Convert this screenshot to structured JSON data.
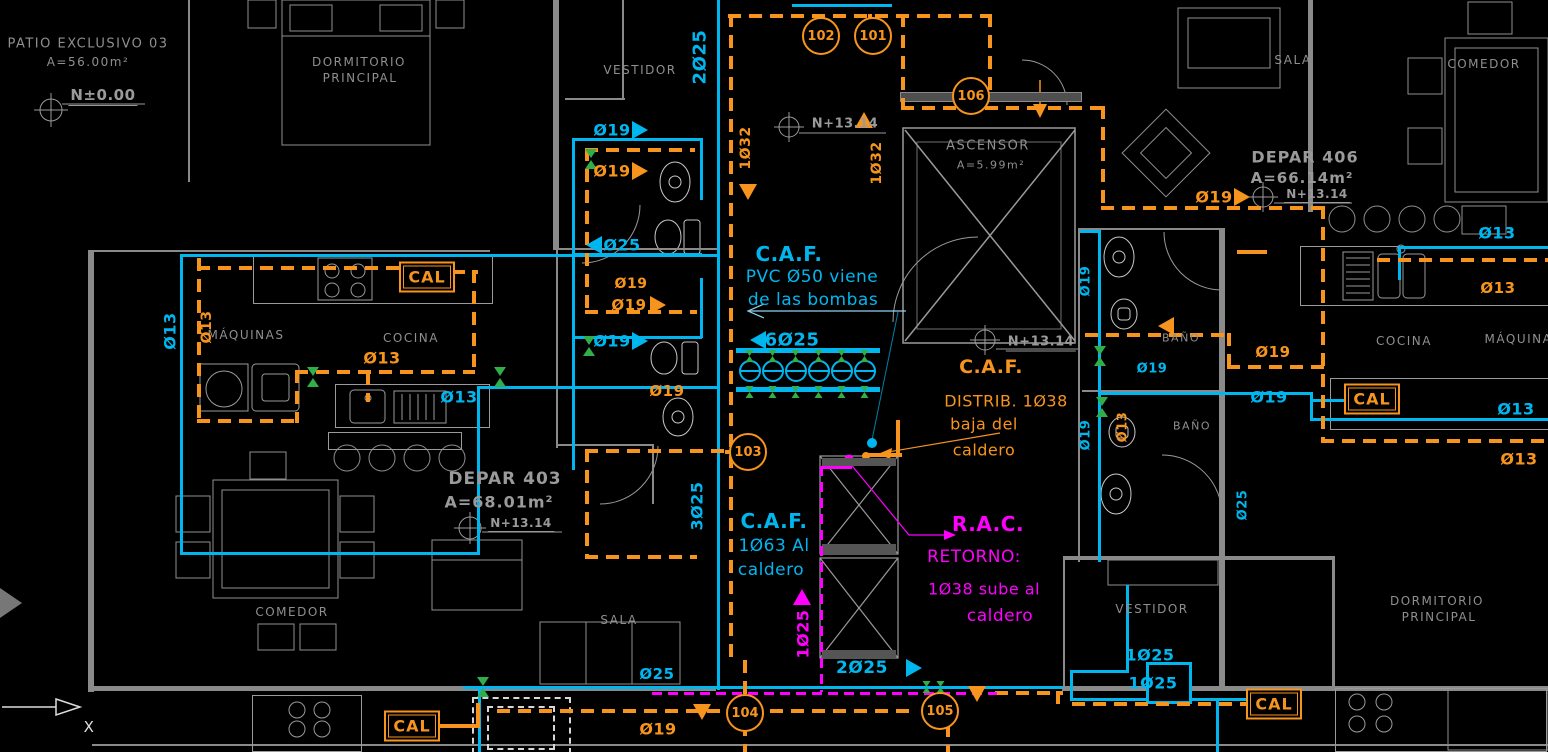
{
  "meta": {
    "background": "#000000",
    "colors": {
      "cold_water_cyan": "#00b6ef",
      "hot_water_orange": "#f7941d",
      "return_magenta": "#ff00ff",
      "valve_green": "#2fae49",
      "architecture_gray": "#8f8f8f"
    }
  },
  "rooms": [
    {
      "t": "PATIO EXCLUSIVO 03",
      "x": 88,
      "y": 44,
      "s": 13
    },
    {
      "t": "A=56.00m²",
      "x": 88,
      "y": 62,
      "s": 12
    },
    {
      "t": "DORMITORIO",
      "x": 359,
      "y": 62,
      "s": 12
    },
    {
      "t": "PRINCIPAL",
      "x": 360,
      "y": 78,
      "s": 12
    },
    {
      "t": "VESTIDOR",
      "x": 640,
      "y": 70,
      "s": 12
    },
    {
      "t": "ASCENSOR",
      "x": 988,
      "y": 146,
      "s": 13
    },
    {
      "t": "A=5.99m²",
      "x": 991,
      "y": 165,
      "s": 11
    },
    {
      "t": "SALA",
      "x": 1293,
      "y": 60,
      "s": 12
    },
    {
      "t": "COMEDOR",
      "x": 1484,
      "y": 64,
      "s": 12
    },
    {
      "t": "MÁQUINAS",
      "x": 246,
      "y": 335,
      "s": 12
    },
    {
      "t": "COCINA",
      "x": 411,
      "y": 338,
      "s": 12
    },
    {
      "t": "COMEDOR",
      "x": 292,
      "y": 612,
      "s": 12
    },
    {
      "t": "SALA",
      "x": 619,
      "y": 620,
      "s": 12
    },
    {
      "t": "BAÑO",
      "x": 1181,
      "y": 338,
      "s": 11
    },
    {
      "t": "BAÑO",
      "x": 1192,
      "y": 426,
      "s": 11
    },
    {
      "t": "COCINA",
      "x": 1404,
      "y": 341,
      "s": 12
    },
    {
      "t": "MÁQUINAS",
      "x": 1523,
      "y": 339,
      "s": 12
    },
    {
      "t": "VESTIDOR",
      "x": 1152,
      "y": 609,
      "s": 12
    },
    {
      "t": "DORMITORIO",
      "x": 1437,
      "y": 601,
      "s": 12
    },
    {
      "t": "PRINCIPAL",
      "x": 1439,
      "y": 617,
      "s": 12
    }
  ],
  "areas": [
    {
      "t": "DEPAR 403",
      "x": 505,
      "y": 479,
      "s": 17
    },
    {
      "t": "A=68.01m²",
      "x": 499,
      "y": 502,
      "s": 16
    },
    {
      "t": "DEPAR 406",
      "x": 1305,
      "y": 157,
      "s": 16
    },
    {
      "t": "A=66.14m²",
      "x": 1302,
      "y": 178,
      "s": 15
    }
  ],
  "levels": [
    {
      "t": "N±0.00",
      "x": 103,
      "y": 96,
      "s": 15
    },
    {
      "t": "N+13.14",
      "x": 845,
      "y": 125,
      "s": 13
    },
    {
      "t": "N+13.14",
      "x": 1041,
      "y": 343,
      "s": 13
    },
    {
      "t": "N+13.14",
      "x": 1317,
      "y": 195,
      "s": 12
    },
    {
      "t": "N+13.14",
      "x": 521,
      "y": 524,
      "s": 12
    }
  ],
  "pipe_labels": [
    {
      "t": "2Ø25",
      "x": 700,
      "y": 57,
      "c": "cy",
      "r": 1,
      "s": 18
    },
    {
      "t": "Ø19",
      "x": 612,
      "y": 130,
      "c": "cy",
      "s": 16
    },
    {
      "t": "Ø25",
      "x": 622,
      "y": 245,
      "c": "cy",
      "s": 16
    },
    {
      "t": "Ø19",
      "x": 612,
      "y": 341,
      "c": "cy",
      "s": 16
    },
    {
      "t": "Ø13",
      "x": 170,
      "y": 331,
      "c": "cy",
      "r": 1,
      "s": 16
    },
    {
      "t": "Ø13",
      "x": 459,
      "y": 397,
      "c": "cy",
      "s": 16
    },
    {
      "t": "6Ø25",
      "x": 792,
      "y": 340,
      "c": "cy",
      "s": 18
    },
    {
      "t": "3Ø25",
      "x": 697,
      "y": 506,
      "c": "cy",
      "r": 1,
      "s": 16
    },
    {
      "t": "Ø25",
      "x": 657,
      "y": 674,
      "c": "cy",
      "s": 15
    },
    {
      "t": "2Ø25",
      "x": 862,
      "y": 668,
      "c": "cy",
      "s": 17
    },
    {
      "t": "Ø13",
      "x": 1497,
      "y": 233,
      "c": "cy",
      "s": 16
    },
    {
      "t": "Ø13",
      "x": 1516,
      "y": 409,
      "c": "cy",
      "s": 16
    },
    {
      "t": "Ø19",
      "x": 1086,
      "y": 281,
      "c": "cy",
      "r": 1,
      "s": 13
    },
    {
      "t": "Ø19",
      "x": 1086,
      "y": 435,
      "c": "cy",
      "r": 1,
      "s": 13
    },
    {
      "t": "Ø19",
      "x": 1152,
      "y": 369,
      "c": "cy",
      "s": 13
    },
    {
      "t": "Ø19",
      "x": 1269,
      "y": 397,
      "c": "cy",
      "s": 16
    },
    {
      "t": "Ø25",
      "x": 1243,
      "y": 505,
      "c": "cy",
      "r": 1,
      "s": 13
    },
    {
      "t": "1Ø25",
      "x": 1150,
      "y": 655,
      "c": "cy",
      "s": 16
    },
    {
      "t": "1Ø25",
      "x": 1153,
      "y": 683,
      "c": "cy",
      "s": 16
    },
    {
      "t": "Ø19",
      "x": 612,
      "y": 171,
      "c": "or",
      "s": 16
    },
    {
      "t": "Ø19",
      "x": 631,
      "y": 284,
      "c": "or",
      "s": 14
    },
    {
      "t": "Ø19",
      "x": 629,
      "y": 305,
      "c": "or",
      "s": 15
    },
    {
      "t": "Ø19",
      "x": 667,
      "y": 391,
      "c": "or",
      "s": 15
    },
    {
      "t": "Ø13",
      "x": 207,
      "y": 327,
      "c": "or",
      "r": 1,
      "s": 14
    },
    {
      "t": "Ø13",
      "x": 382,
      "y": 358,
      "c": "or",
      "s": 16
    },
    {
      "t": "1Ø32",
      "x": 746,
      "y": 148,
      "c": "or",
      "r": 1,
      "s": 14
    },
    {
      "t": "1Ø32",
      "x": 877,
      "y": 163,
      "c": "or",
      "r": 1,
      "s": 14
    },
    {
      "t": "Ø19",
      "x": 1214,
      "y": 197,
      "c": "or",
      "s": 16
    },
    {
      "t": "Ø19",
      "x": 1273,
      "y": 352,
      "c": "or",
      "s": 15
    },
    {
      "t": "Ø13",
      "x": 1498,
      "y": 288,
      "c": "or",
      "s": 15
    },
    {
      "t": "Ø13",
      "x": 1519,
      "y": 459,
      "c": "or",
      "s": 16
    },
    {
      "t": "Ø13",
      "x": 1123,
      "y": 427,
      "c": "or",
      "r": 1,
      "s": 13
    },
    {
      "t": "Ø19",
      "x": 658,
      "y": 729,
      "c": "or",
      "s": 16
    },
    {
      "t": "1Ø25",
      "x": 803,
      "y": 634,
      "c": "mg",
      "r": 1,
      "s": 16
    }
  ],
  "notes": {
    "caf_supply": {
      "title": "C.A.F.",
      "line1": "PVC Ø50 viene",
      "line2": "de las bombas"
    },
    "caf_distrib": {
      "title": "C.A.F.",
      "line1": "DISTRIB. 1Ø38",
      "line2": "baja del",
      "line3": "caldero"
    },
    "caf_boiler": {
      "title": "C.A.F.",
      "line1": "1Ø63 Al",
      "line2": "caldero"
    },
    "rac": {
      "title": "R.A.C.",
      "line1": "RETORNO:",
      "line2": "1Ø38 sube al",
      "line3": "caldero"
    }
  },
  "cal_tags": [
    {
      "t": "CAL",
      "x": 427,
      "y": 277
    },
    {
      "t": "CAL",
      "x": 1372,
      "y": 399
    },
    {
      "t": "CAL",
      "x": 412,
      "y": 726
    },
    {
      "t": "CAL",
      "x": 1274,
      "y": 704
    }
  ],
  "refs": [
    {
      "t": "102",
      "x": 821,
      "y": 36
    },
    {
      "t": "101",
      "x": 873,
      "y": 36
    },
    {
      "t": "106",
      "x": 971,
      "y": 96
    },
    {
      "t": "103",
      "x": 748,
      "y": 452
    },
    {
      "t": "104",
      "x": 745,
      "y": 713
    },
    {
      "t": "105",
      "x": 940,
      "y": 711
    }
  ],
  "axis": {
    "x_label": "X"
  }
}
